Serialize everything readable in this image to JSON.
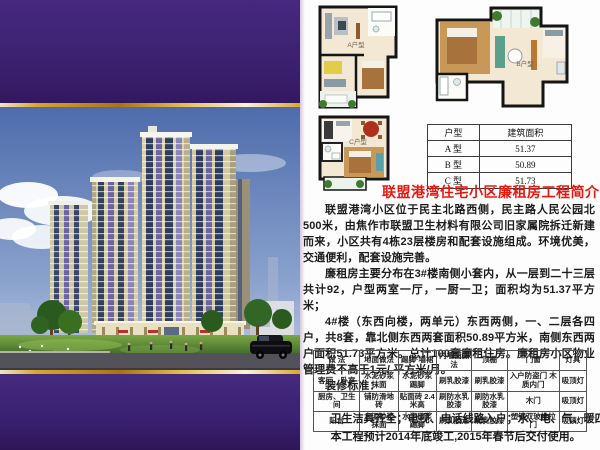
{
  "colors": {
    "banner_purple": "#3A1F6C",
    "gold_accent": "#D8A72E",
    "title_red": "#E8170F"
  },
  "floor_plans": [
    {
      "label": "A户型"
    },
    {
      "label": "B户型"
    },
    {
      "label": "C户型"
    }
  ],
  "unit_table": {
    "headers": [
      "户型",
      "建筑面积"
    ],
    "rows": [
      [
        "A 型",
        "51.37"
      ],
      [
        "B 型",
        "50.89"
      ],
      [
        "C 型",
        "51.73"
      ]
    ]
  },
  "title": "联盟港湾住宅小区廉租房工程简介",
  "intro": {
    "p1": "联盟港湾小区位于民主北路西侧，民主路人民公园北500米，由焦作市联盟卫生材料有限公司旧家属院拆迁新建而来，小区共有4栋23层楼房和配套设施组成。环境优美，交通便利，配套设施完善。",
    "p2": "廉租房主要分布在3#楼南侧小套内，从一层到二十三层共计92，户型两室一厅，一厨一卫；面积均为51.37平方米；",
    "p3": "4#楼（东西向楼，两单元）东西两侧，一、二层各四户，共8套，靠北侧东西两套面积50.89平方米，南侧东西两户面积51.73平方米。总计100套廉租住房。廉租房小区物业管理费不高于1元/ 平方米/月。",
    "standards_label": "装修标准："
  },
  "standards_table": {
    "headers": [
      "做  法",
      "地面做法",
      "踢脚·墙裙",
      "内墙面做法",
      "顶棚",
      "门窗",
      "灯具"
    ],
    "rows": [
      [
        "客厅、卧室",
        "水泥砂浆抹面",
        "水泥砂浆踢脚",
        "刷乳胶漆",
        "刷乳胶漆",
        "入户防盗门 木质内门",
        "吸顶灯"
      ],
      [
        "厨房、卫生间",
        "铺防滑地砖",
        "贴面砖 2.4 米高",
        "刷防水乳胶漆",
        "刷防水乳胶漆",
        "木门",
        "吸顶灯"
      ],
      [
        "阳台",
        "水泥砂浆抹面",
        "水泥砂浆踢脚",
        "刷乳胶漆",
        "刷乳胶漆",
        "塑钢双玻推拉门",
        "吸顶灯"
      ]
    ]
  },
  "footnotes": {
    "line1": "卫生洁具齐全；电视、电话线路入户；水、电、气、暖四通。",
    "line2": "本工程预计2014年底竣工,2015年春节后交付使用。"
  }
}
